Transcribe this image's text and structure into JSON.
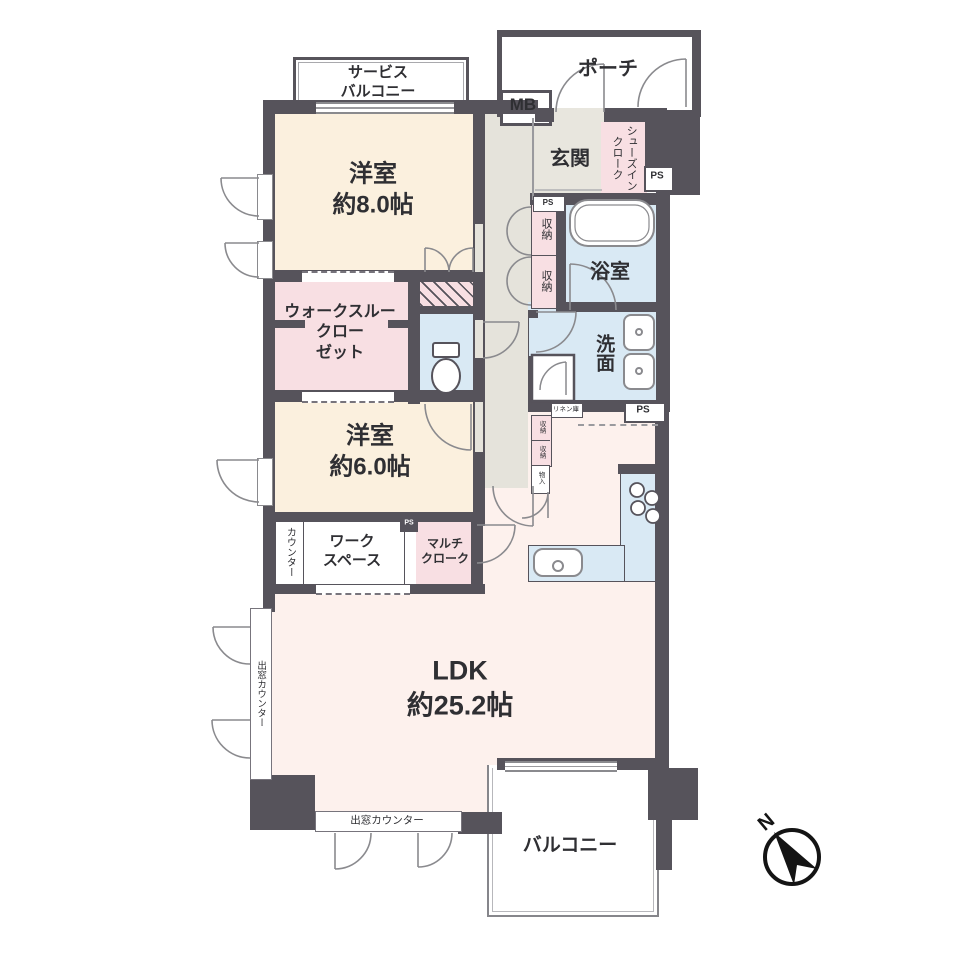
{
  "plan_type": "madori-floor-plan",
  "colors": {
    "wall": "#56535b",
    "room_cream": "#fbf0de",
    "room_pink": "#f8dfe3",
    "room_blue": "#d9e9f4",
    "corridor_gray": "#e5e3db",
    "ldk_pink": "#fdf1ed"
  },
  "rooms": {
    "service_balcony": "サービス\nバルコニー",
    "porch": "ポーチ",
    "mb": "MB",
    "genkan": "玄関",
    "shoes_in_cloak": "シューズイン\nクローク",
    "western_8": "洋室\n約8.0帖",
    "storage_upper": "収納",
    "storage_lower": "収納",
    "bathroom": "浴室",
    "walk_through_closet": "ウォークスルー\nクロー\nゼット",
    "washroom": "洗面",
    "western_6": "洋室\n約6.0帖",
    "counter": "カウンター",
    "workspace": "ワーク\nスペース",
    "multi_cloak": "マルチ\nクローク",
    "linen": "リネン庫",
    "storage_small_1": "収納",
    "storage_small_2": "収納",
    "storage_small_3": "物入",
    "ldk": "LDK\n約25.2帖",
    "bay_counter_left": "出窓カウンター",
    "bay_counter_bottom": "出窓カウンター",
    "balcony": "バルコニー"
  },
  "labels": {
    "ps": "PS",
    "north": "N"
  }
}
